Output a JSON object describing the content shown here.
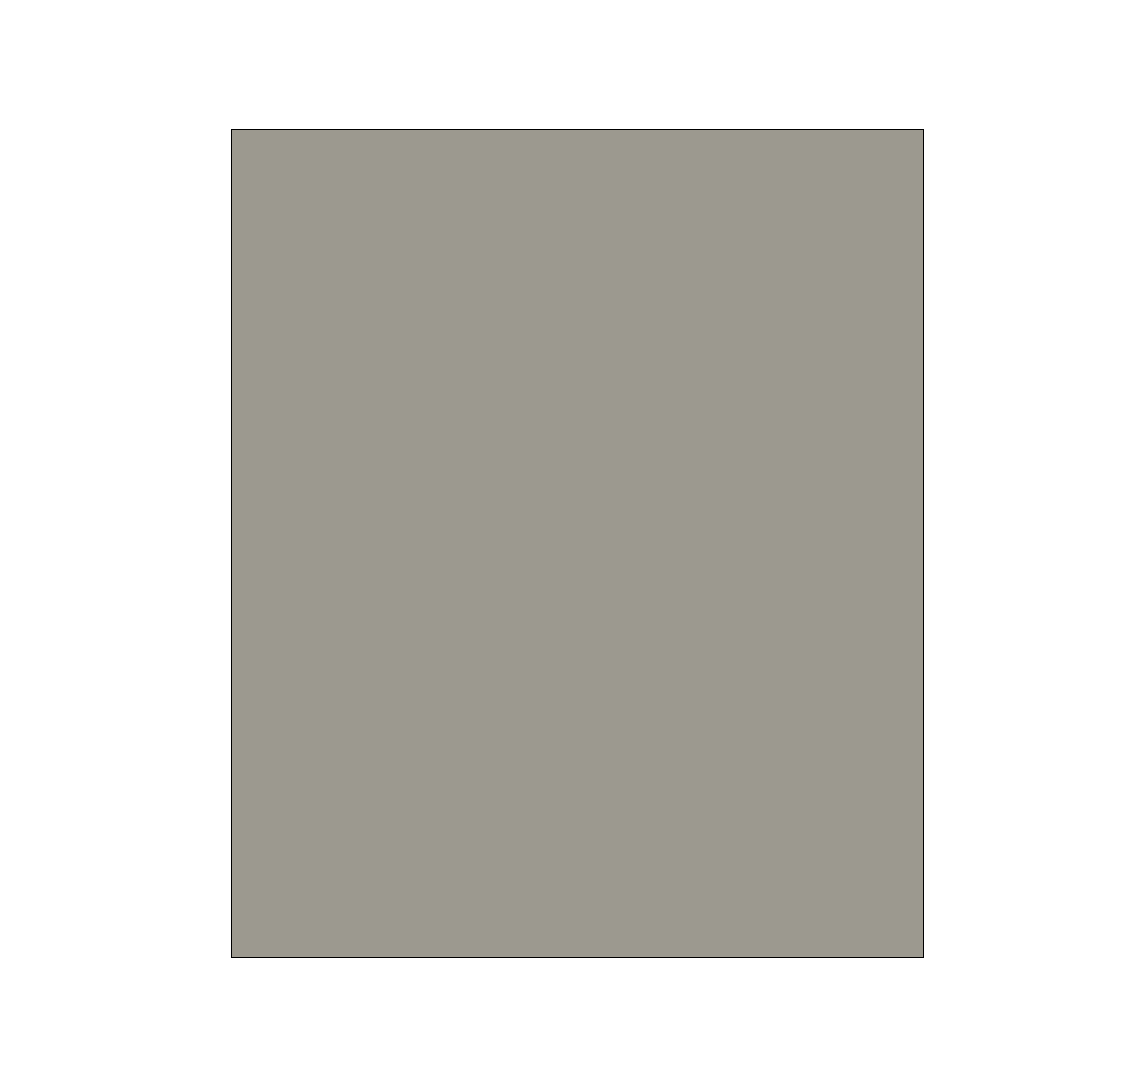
{
  "figure": {
    "xlabel": "Casa Del Sol Street, Mesa Street, Santa Clara, California, USA",
    "background": "#ffffff",
    "extent": {
      "lon_min": -121.5712,
      "lon_max": -121.56776,
      "lat_min": 36.99599,
      "lat_max": 36.99926
    },
    "xaxis": {
      "ticks": [
        -121.571,
        -121.5705,
        -121.57,
        -121.5695,
        -121.569,
        -121.5685,
        -121.568
      ],
      "tick_labels": [
        "−121.5710",
        "−121.5705",
        "−121.5700",
        "−121.5695",
        "−121.5690",
        "−121.5685",
        "−121.5680"
      ]
    },
    "yaxis": {
      "ticks": [
        36.999,
        36.9985,
        36.998,
        36.9975,
        36.997,
        36.9965,
        36.996
      ],
      "tick_labels": [
        "36.9990",
        "36.9985",
        "36.9980",
        "36.9975",
        "36.9970",
        "36.9965",
        "36.9960"
      ]
    }
  },
  "map_overlay": {
    "colors": {
      "edge_outline": "#38d73a",
      "street_fill": "#fafa3e",
      "centerline": "#23268c",
      "centerline_gap": "#fffdf0",
      "crossing_marker": "#ffffff",
      "node_fill": "#f6f545"
    },
    "streets": [
      {
        "name": "Mesa Street",
        "path": [
          [
            -121.56958,
            36.99877
          ],
          [
            -121.56902,
            36.9974
          ],
          [
            -121.56836,
            36.99607
          ]
        ]
      },
      {
        "name": "Casa Del Sol Street",
        "path": [
          [
            -121.57068,
            36.99723
          ],
          [
            -121.56957,
            36.99727
          ],
          [
            -121.56902,
            36.9974
          ]
        ]
      }
    ],
    "crossings": [
      {
        "lon": -121.56903,
        "lat": 36.99748,
        "angle_deg": -18.3
      },
      {
        "lon": -121.56911,
        "lat": 36.99741,
        "angle_deg": 73.0
      },
      {
        "lon": -121.56902,
        "lat": 36.99734,
        "angle_deg": -21.5
      }
    ],
    "nodes": [
      {
        "lon": -121.56904,
        "lat": 36.99744
      },
      {
        "lon": -121.56902,
        "lat": 36.99737
      }
    ]
  }
}
